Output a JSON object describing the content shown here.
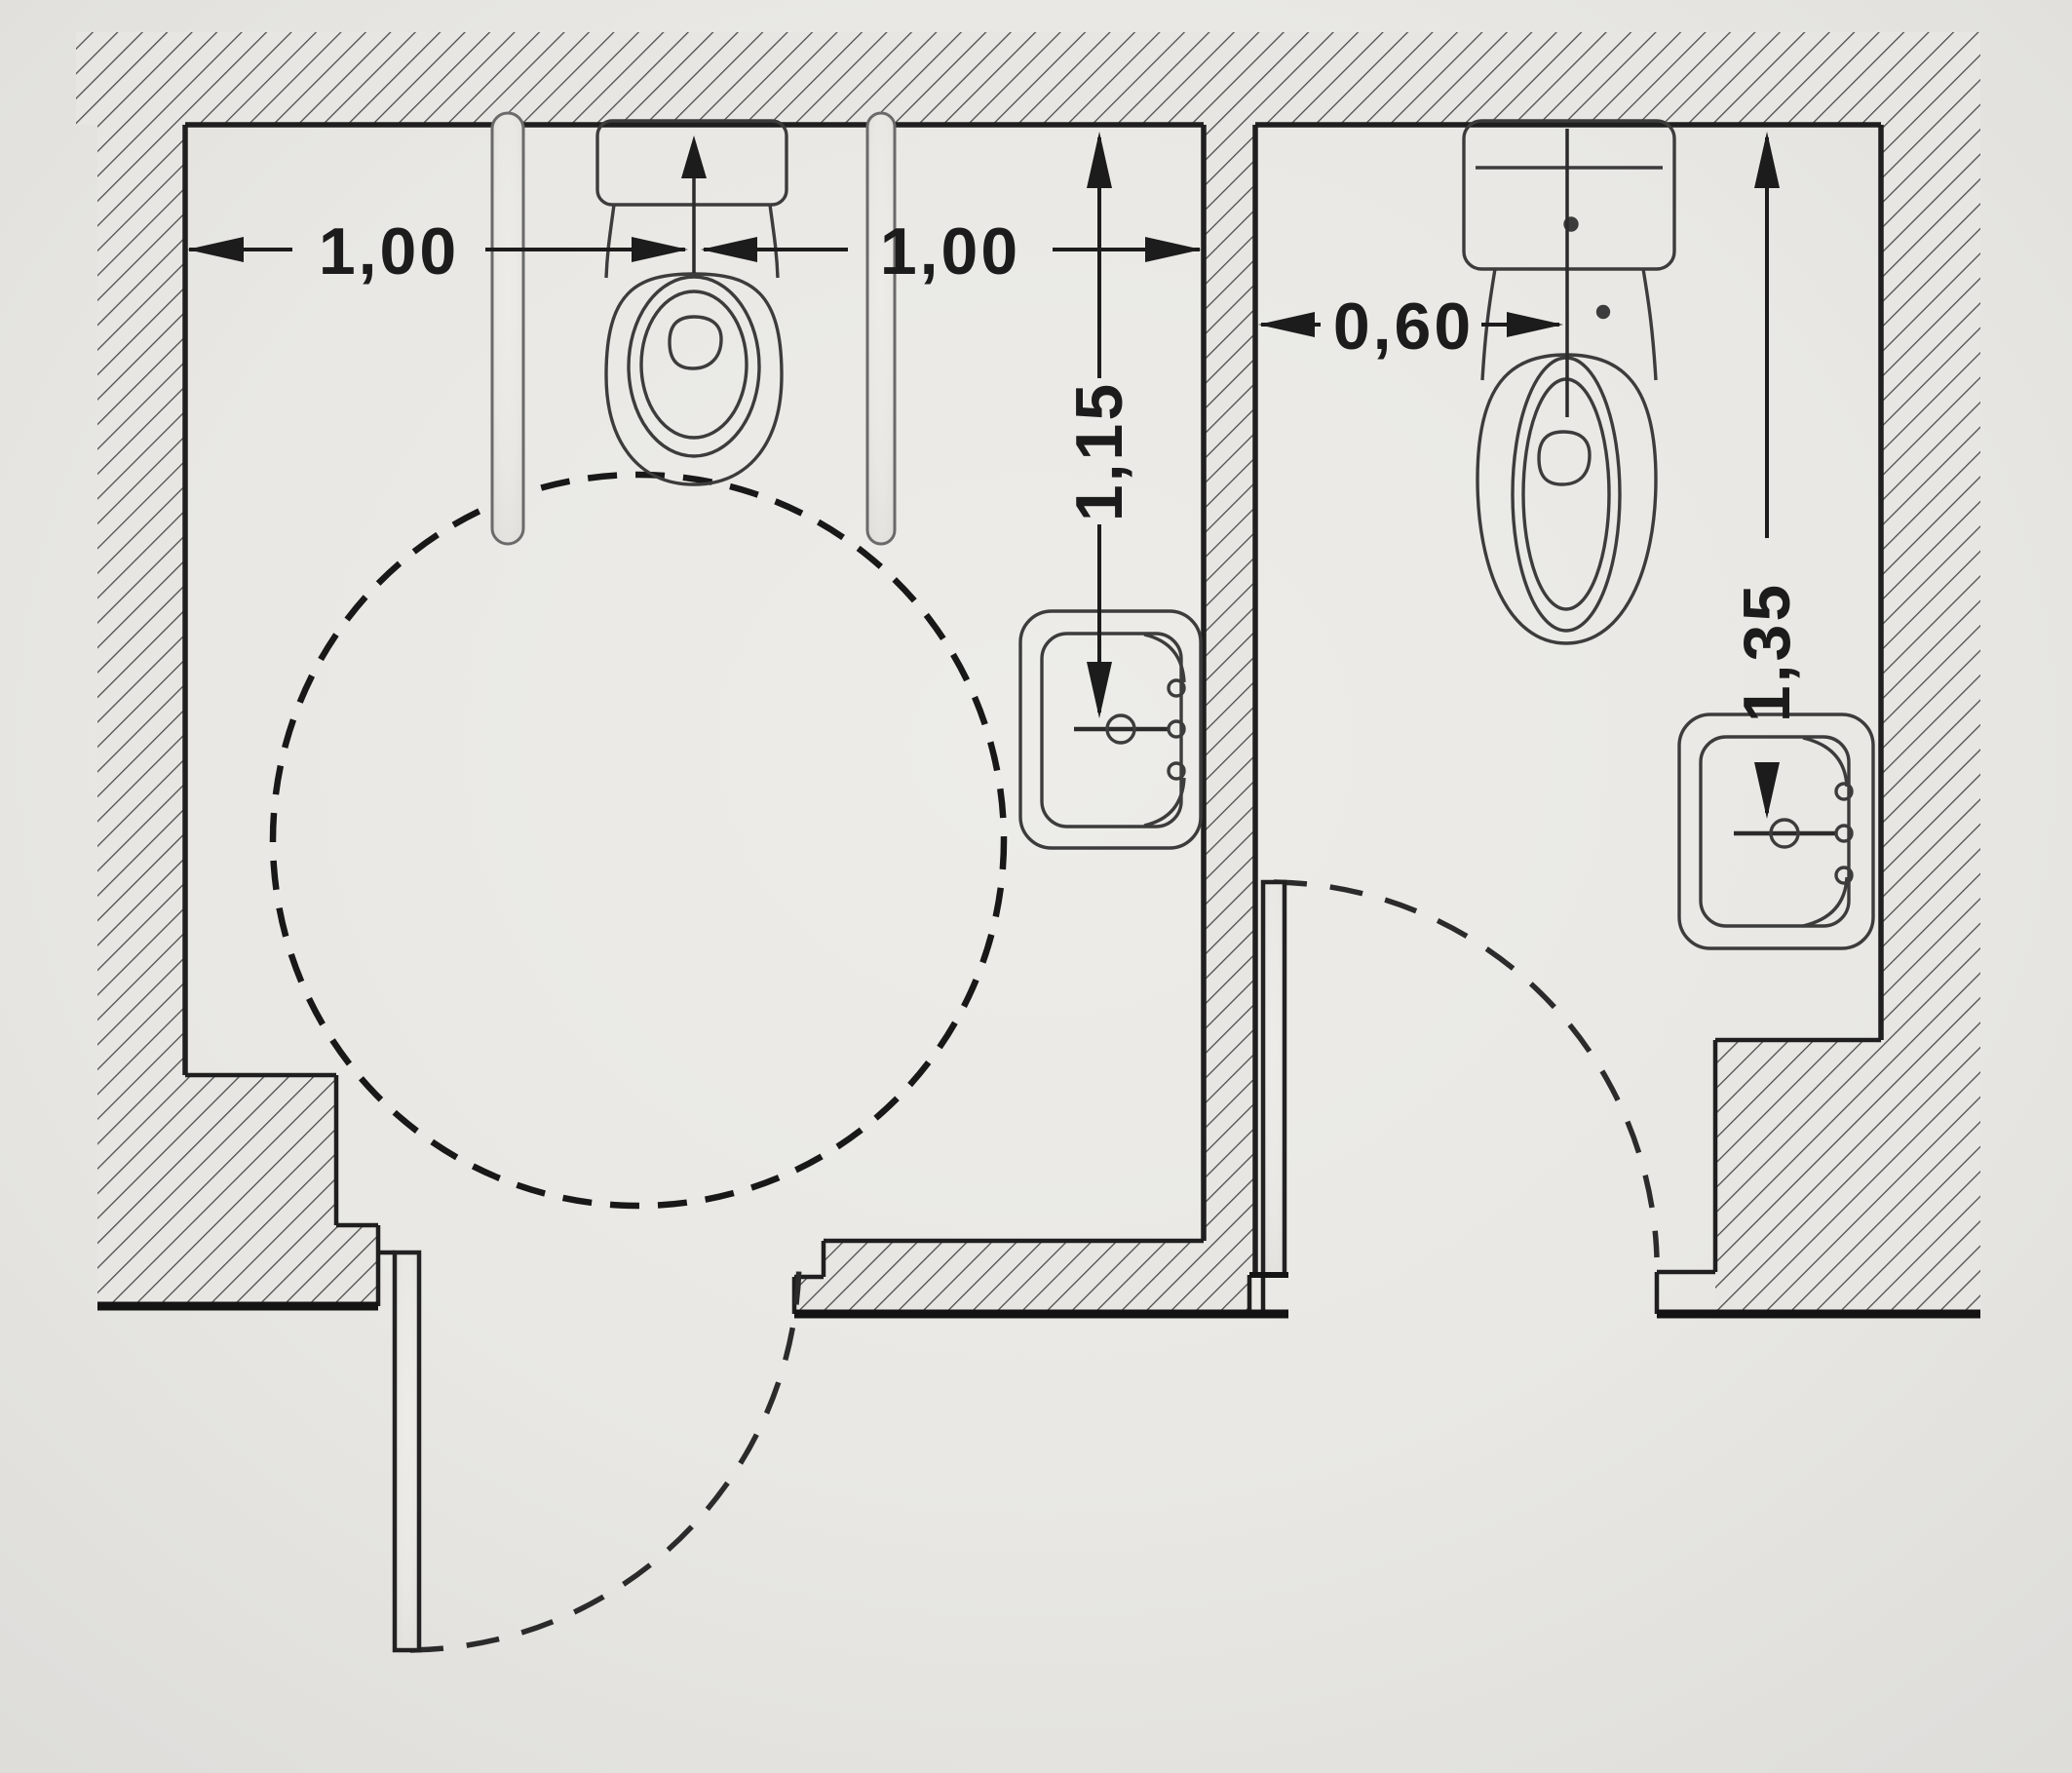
{
  "drawing": {
    "type": "floor-plan",
    "subject": "Two WC cubicles in plan view: accessible WC with grab bars and wheelchair turning circle (left), standard WC (right)",
    "dimension_labels": {
      "left_room_wall_to_toilet_axis": "1,00",
      "left_room_toilet_axis_to_wall": "1,00",
      "left_room_rear_wall_to_washbasin": "1,15",
      "right_room_wall_to_toilet_axis": "0,60",
      "right_room_rear_wall_to_washbasin": "1,35"
    },
    "colors": {
      "paper": "#eae9e5",
      "ink": "#1c1c1c",
      "fixture_line": "#3c3c3c",
      "hatch_line": "#4d4d4d"
    }
  }
}
